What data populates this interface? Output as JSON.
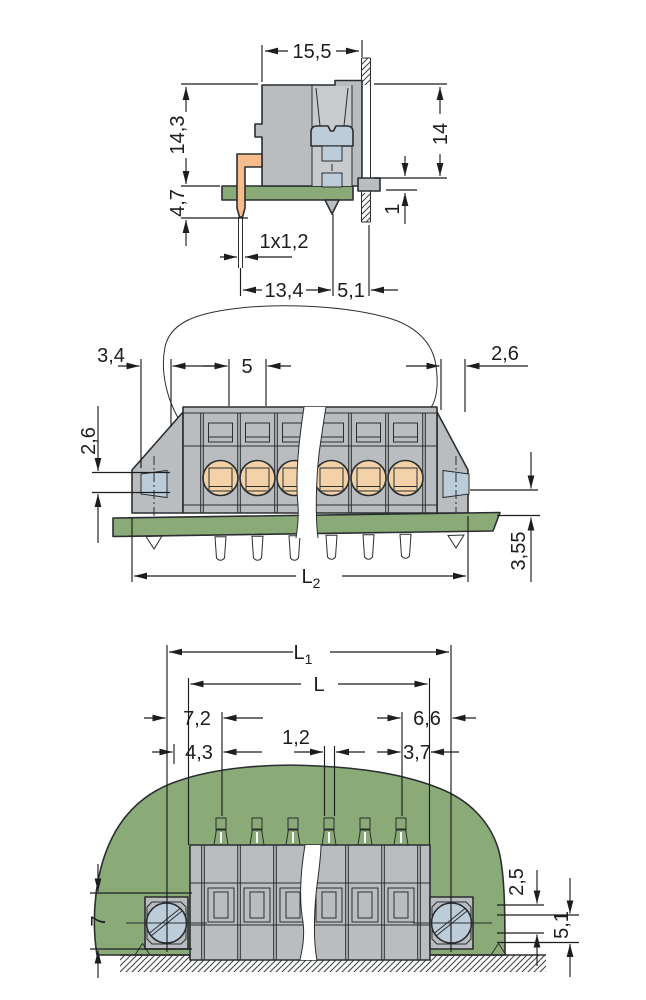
{
  "drawing": {
    "type": "technical-dimension-drawing",
    "subject": "PCB terminal block with screw flanges, three orthographic views",
    "colors": {
      "body_gray": "#b9bdbf",
      "cavity_gray": "#c7cbcd",
      "screw_blue": "#bdccd9",
      "contact_yellow": "#fed500",
      "pin_orange": "#f5bd8c",
      "pcb_green": "#8aab77",
      "line": "#2b2e31",
      "dimension_line": "#1b1d1f",
      "background": "#ffffff"
    },
    "side_view": {
      "dims": {
        "width_top": "15,5",
        "height_left": "14,3",
        "pin_below_board": "4,7",
        "panel_height": "14",
        "panel_clearance": "1",
        "pin_section": "1x1,2",
        "depth": "13,4",
        "panel_offset": "5,1"
      }
    },
    "front_view": {
      "dims": {
        "left_margin": "3,4",
        "pole_pitch": "5",
        "right_margin": "2,6",
        "screw_height": "2,6",
        "below_board": "3,55",
        "length_main": "L",
        "length_sub": "2"
      }
    },
    "plan_view": {
      "dims": {
        "fixing_centers_main": "L",
        "fixing_centers_sub": "1",
        "overall_length": "L",
        "screw_to_pole": "7,2",
        "edge_to_pole": "4,3",
        "slot_width": "1,2",
        "pole_to_screw": "6,6",
        "pole_to_edge": "3,7",
        "flange_width": "7",
        "offset_a": "2,5",
        "offset_b": "5,1"
      }
    }
  }
}
